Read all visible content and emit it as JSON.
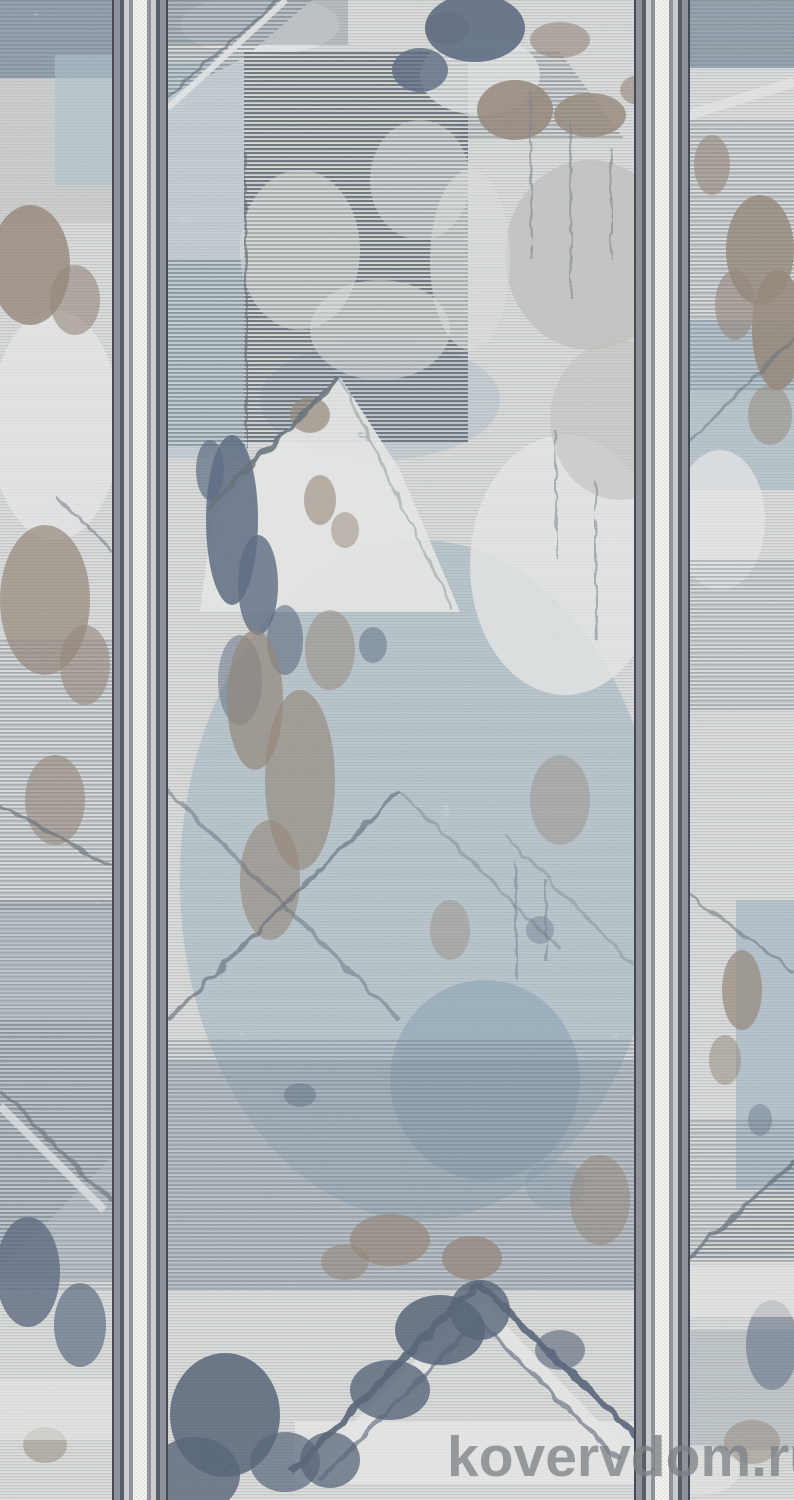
{
  "image": {
    "description": "Distressed abstract runner carpet in blue-gray, taupe and cream; three vertical pattern panels separated by two gray striped borders; photographed flat",
    "watermark": "kovervdom.ru"
  },
  "colors": {
    "base": "#ebeae6",
    "rib": "#a7adb2",
    "hatchDark": "#47525e",
    "hatchMid": "#5f6c79",
    "slate": "#72879a",
    "navy": "#3b4c68",
    "navyDeep": "#32425c",
    "blueSoft": "#8fa9bd",
    "blueStrong": "#7495ae",
    "bluePale": "#aec3d1",
    "brown": "#87725f",
    "brownLight": "#a18c77",
    "cloud": "#c6c3bd",
    "white": "#f7f6f3",
    "borderDark": "#454b54",
    "borderSlate": "#575e67",
    "borderGray": "#8f9399",
    "borderLight": "#cbccce",
    "borderWhite": "#f3f3f1",
    "borderDot": "#d9d9d6",
    "watermark": "#7e8286"
  }
}
